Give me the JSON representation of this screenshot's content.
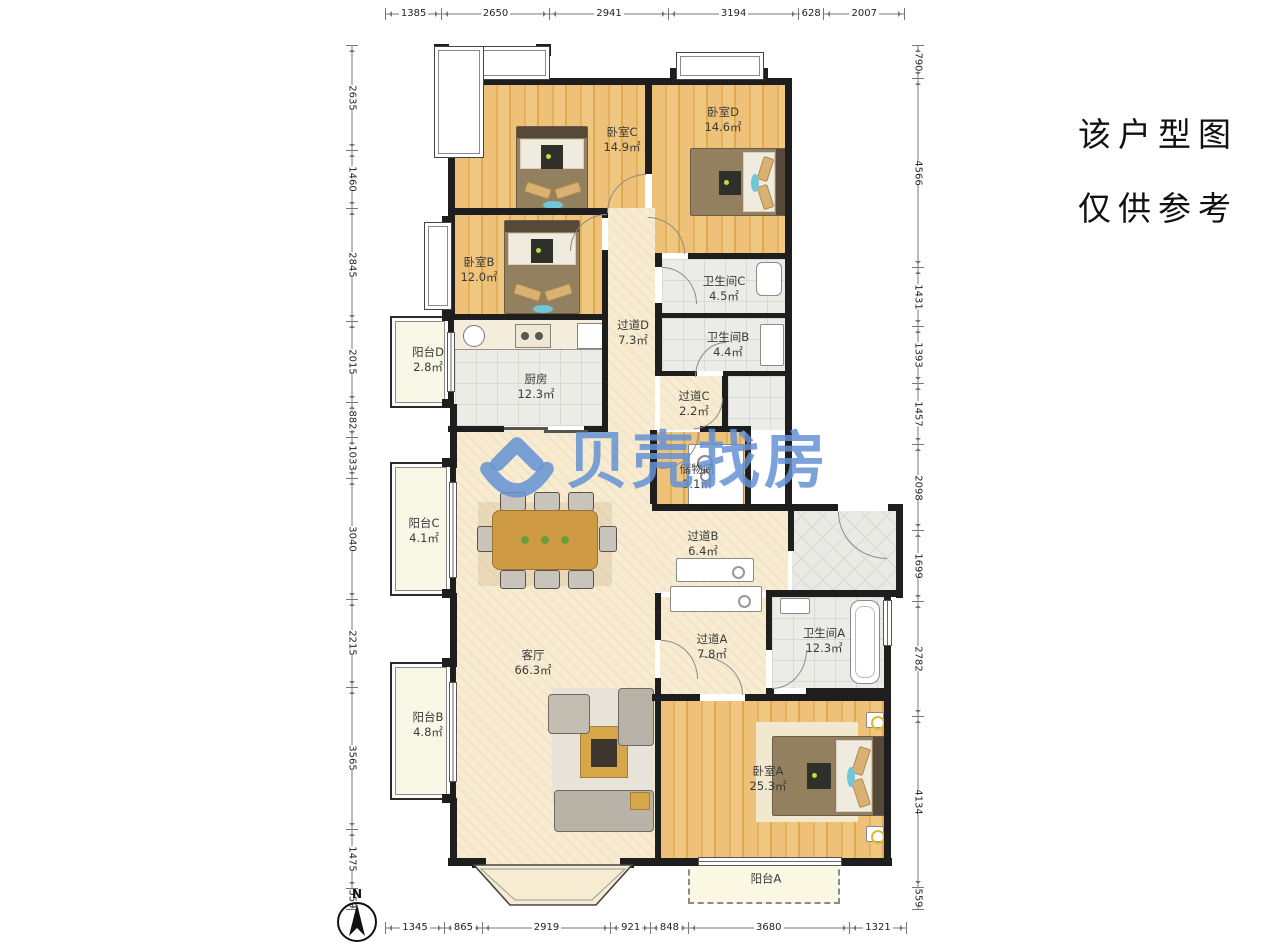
{
  "watermark": {
    "text": "贝壳找房",
    "logo": "beike-house-logo",
    "color": "#6492d4"
  },
  "disclaimer": {
    "line1": "该户型图",
    "line2": "仅供参考"
  },
  "compass": {
    "label": "N"
  },
  "rulers": {
    "top": [
      1385,
      2650,
      2941,
      3194,
      628,
      2007
    ],
    "bottom": [
      1345,
      865,
      2919,
      921,
      848,
      3680,
      1321
    ],
    "left": [
      2635,
      1460,
      2845,
      2015,
      882,
      1033,
      3040,
      2215,
      3565,
      1475,
      559
    ],
    "right": [
      790,
      4566,
      1431,
      1393,
      1457,
      2098,
      1699,
      2782,
      4134,
      559
    ]
  },
  "rooms": {
    "living": {
      "name": "客厅",
      "area": "66.3㎡"
    },
    "kitchen": {
      "name": "厨房",
      "area": "12.3㎡"
    },
    "bedroom_a": {
      "name": "卧室A",
      "area": "25.3㎡"
    },
    "bedroom_b": {
      "name": "卧室B",
      "area": "12.0㎡"
    },
    "bedroom_c": {
      "name": "卧室C",
      "area": "14.9㎡"
    },
    "bedroom_d": {
      "name": "卧室D",
      "area": "14.6㎡"
    },
    "bathroom_a": {
      "name": "卫生间A",
      "area": "12.3㎡"
    },
    "bathroom_b": {
      "name": "卫生间B",
      "area": "4.4㎡"
    },
    "bathroom_c": {
      "name": "卫生间C",
      "area": "4.5㎡"
    },
    "hallway_a": {
      "name": "过道A",
      "area": "7.8㎡"
    },
    "hallway_b": {
      "name": "过道B",
      "area": "6.4㎡"
    },
    "hallway_c": {
      "name": "过道C",
      "area": "2.2㎡"
    },
    "hallway_d": {
      "name": "过道D",
      "area": "7.3㎡"
    },
    "storage": {
      "name": "储物间",
      "area": "3.1㎡"
    },
    "balcony_a": {
      "name": "阳台A",
      "area": ""
    },
    "balcony_b": {
      "name": "阳台B",
      "area": "4.8㎡"
    },
    "balcony_c": {
      "name": "阳台C",
      "area": "4.1㎡"
    },
    "balcony_d": {
      "name": "阳台D",
      "area": "2.8㎡"
    }
  }
}
